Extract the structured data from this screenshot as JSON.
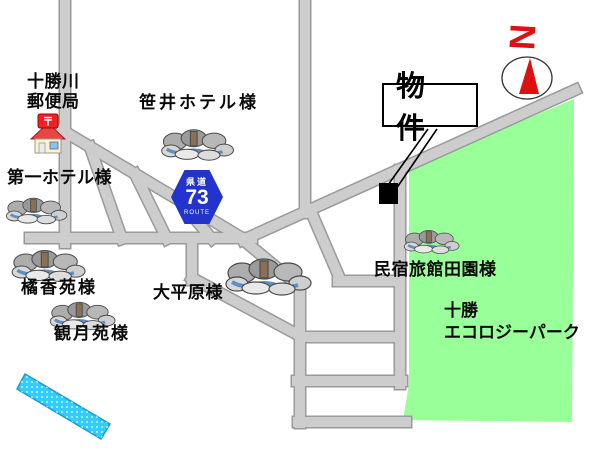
{
  "map": {
    "colors": {
      "park_green": "#99ff99",
      "road_gray": "#cdcdcd",
      "road_edge_gray": "#9a9a9a",
      "river_cyan": "#33ccff",
      "shield_blue": "#2334cc",
      "accent_red": "#dd1111",
      "property_black": "#000000"
    },
    "compass": {
      "north_label": "N"
    },
    "route_shield": {
      "prefecture_text": "県道",
      "route_number": "73",
      "route_text": "ROUTE"
    },
    "property_callout": {
      "label": "物件"
    },
    "park": {
      "name_line1": "十勝",
      "name_line2": "エコロジーパーク"
    },
    "pois": {
      "post_office": {
        "name_line1": "十勝川",
        "name_line2": "郵便局"
      },
      "sasai_hotel": {
        "label": "笹井ホテル様"
      },
      "daiichi_hotel": {
        "label": "第一ホテル様"
      },
      "kikkoen": {
        "label": "橘香苑様"
      },
      "kangetsuen": {
        "label": "観月苑様"
      },
      "daiheigen": {
        "label": "大平原様"
      },
      "dennen_inn": {
        "label": "民宿旅館田園様"
      }
    }
  }
}
